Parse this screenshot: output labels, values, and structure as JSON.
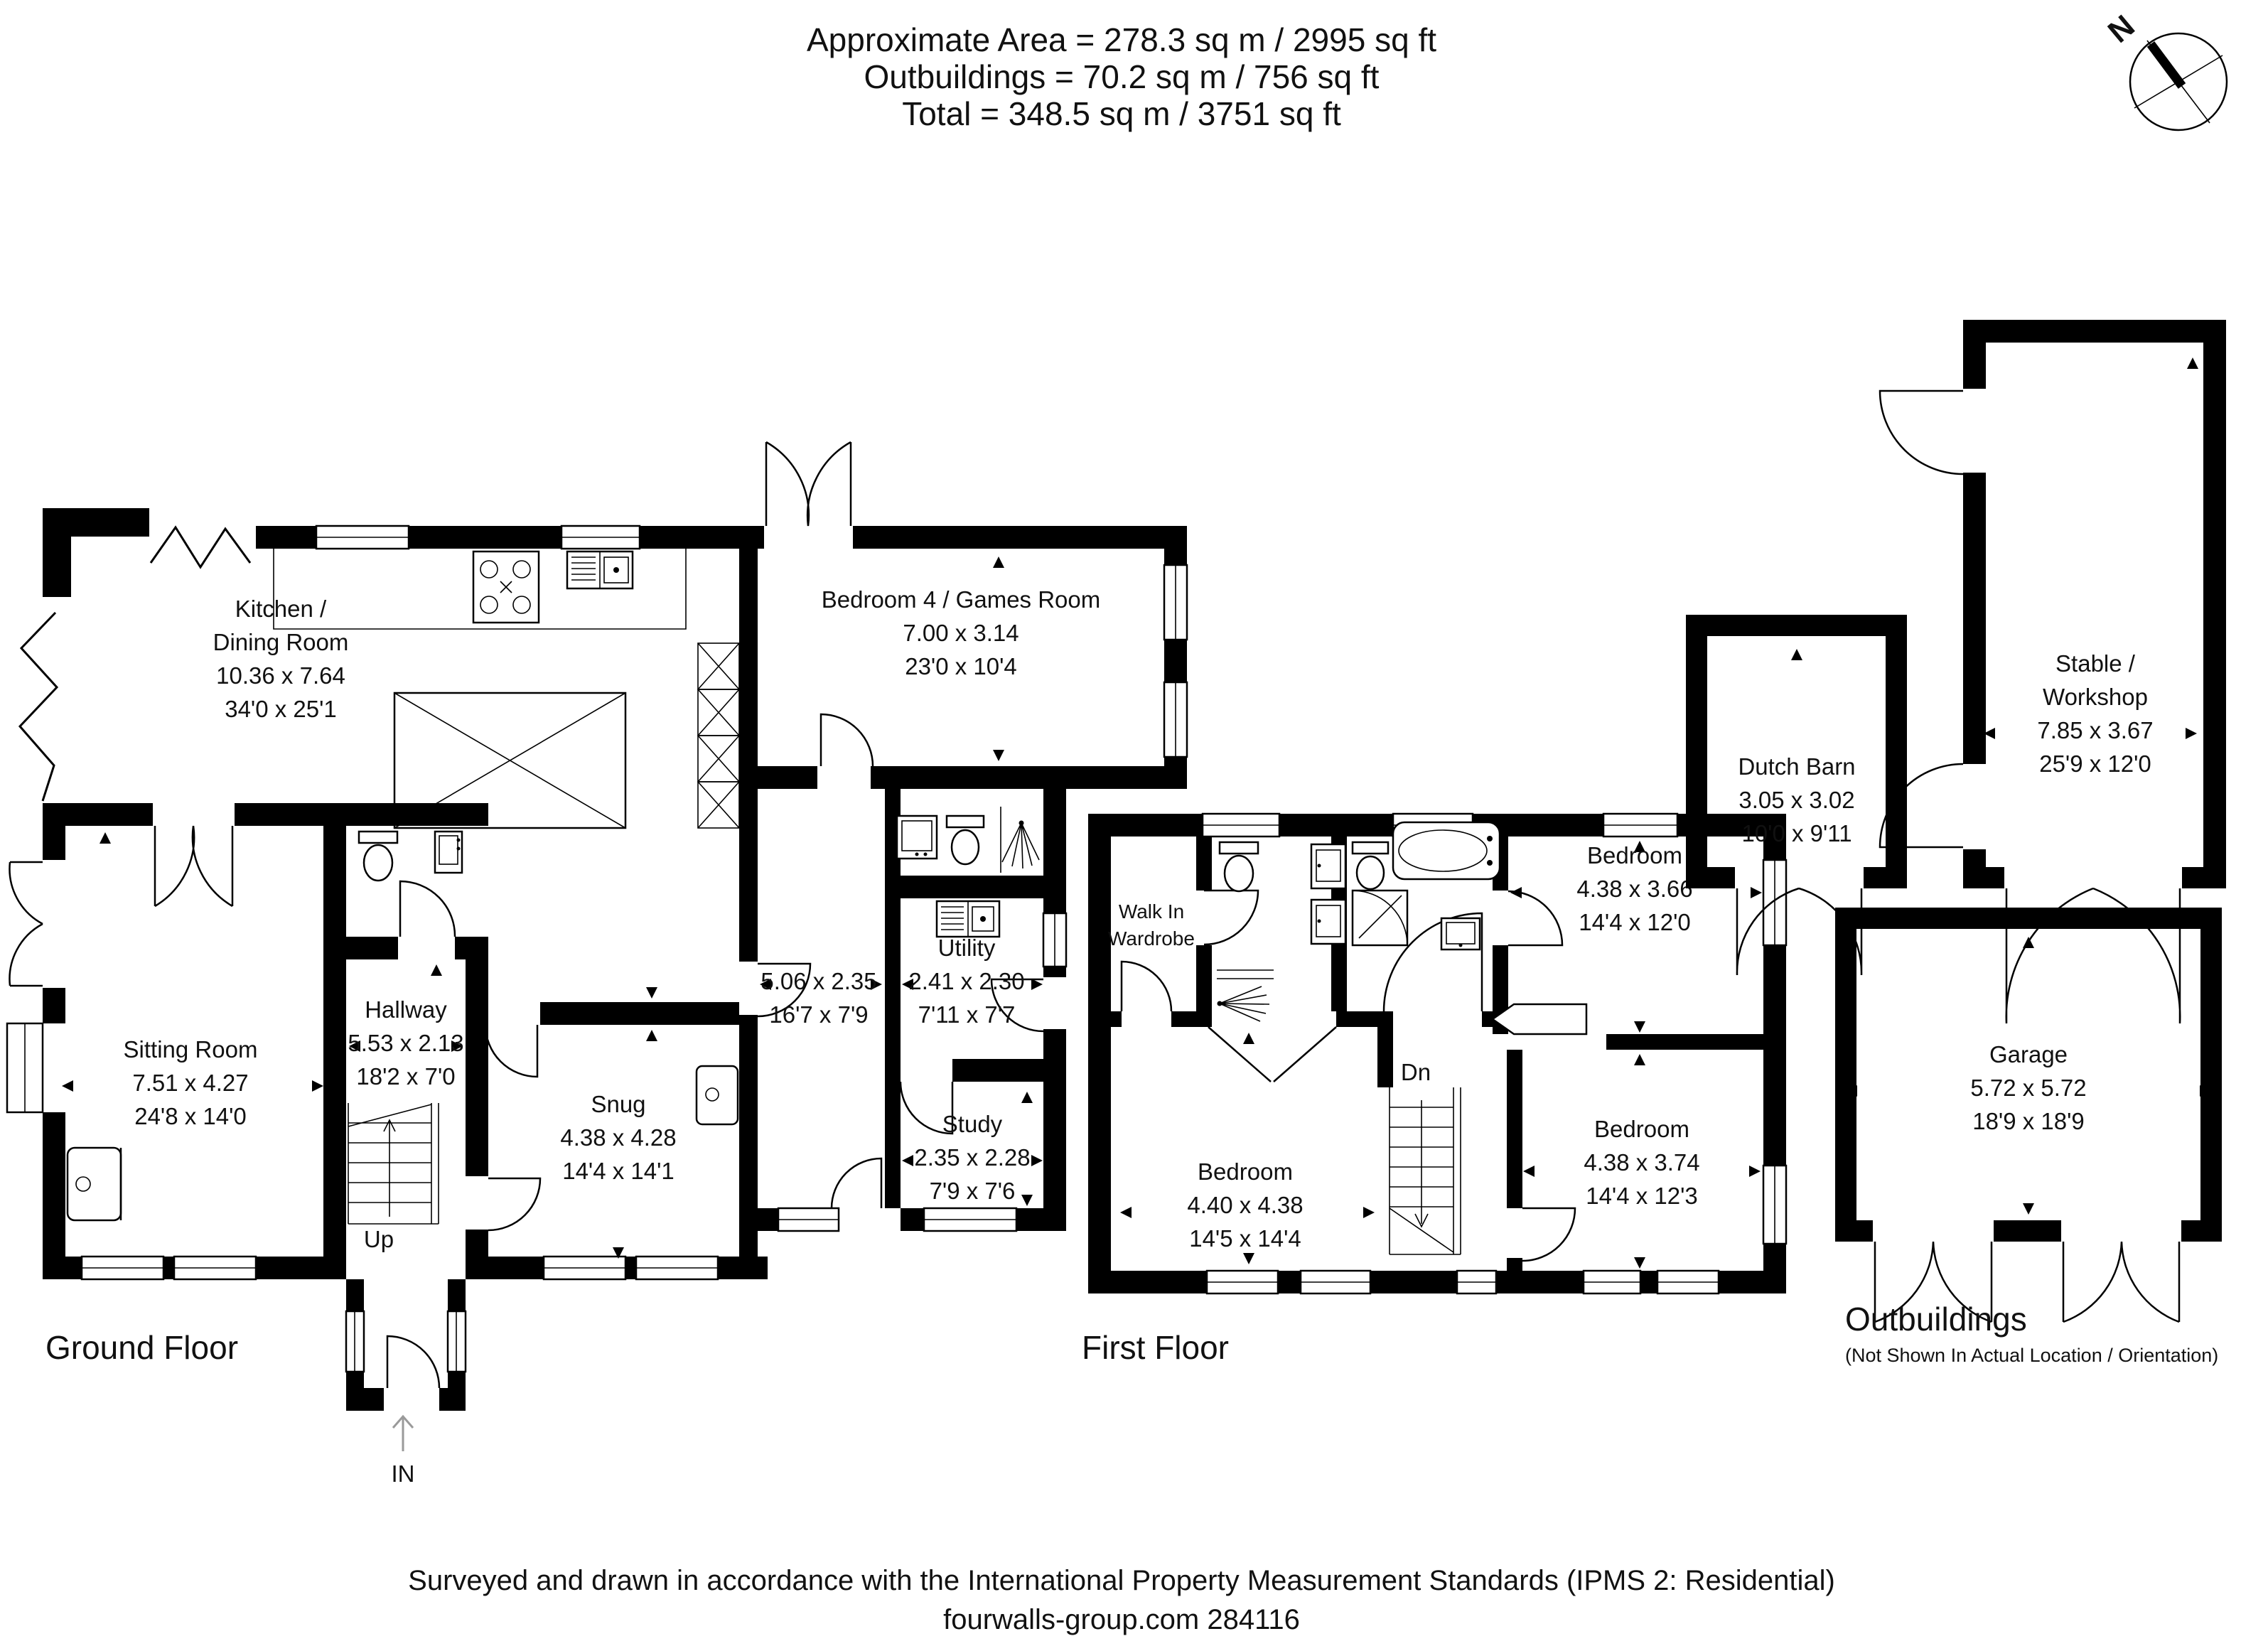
{
  "header": {
    "area_line": "Approximate  Area = 278.3 sq m / 2995 sq ft",
    "outbuildings_line": "Outbuildings = 70.2 sq m / 756 sq ft",
    "total_line": "Total = 348.5 sq m / 3751 sq ft"
  },
  "compass": {
    "north": "N"
  },
  "ground_floor": {
    "label": "Ground Floor",
    "stairs": "Up",
    "entrance": "IN",
    "rooms": {
      "kitchen": {
        "name_line1": "Kitchen /",
        "name_line2": "Dining Room",
        "metric": "10.36 x 7.64",
        "imperial": "34'0 x 25'1"
      },
      "bedroom4": {
        "name": "Bedroom 4 / Games Room",
        "metric": "7.00 x 3.14",
        "imperial": "23'0 x 10'4"
      },
      "sitting_room": {
        "name": "Sitting Room",
        "metric": "7.51 x 4.27",
        "imperial": "24'8 x 14'0"
      },
      "hallway": {
        "name": "Hallway",
        "metric": "5.53 x 2.13",
        "imperial": "18'2 x 7'0"
      },
      "snug": {
        "name": "Snug",
        "metric": "4.38 x 4.28",
        "imperial": "14'4 x 14'1"
      },
      "inner_hall": {
        "metric": "5.06 x 2.35",
        "imperial": "16'7 x 7'9"
      },
      "utility": {
        "name": "Utility",
        "metric": "2.41 x 2.30",
        "imperial": "7'11 x 7'7"
      },
      "study": {
        "name": "Study",
        "metric": "2.35 x 2.28",
        "imperial": "7'9 x 7'6"
      }
    }
  },
  "first_floor": {
    "label": "First Floor",
    "stairs": "Dn",
    "rooms": {
      "walk_in_wardrobe": {
        "name_line1": "Walk In",
        "name_line2": "Wardrobe"
      },
      "bedroom1": {
        "name": "Bedroom",
        "metric": "4.40 x 4.38",
        "imperial": "14'5 x 14'4"
      },
      "bedroom2": {
        "name": "Bedroom",
        "metric": "4.38 x 3.66",
        "imperial": "14'4 x 12'0"
      },
      "bedroom3": {
        "name": "Bedroom",
        "metric": "4.38 x 3.74",
        "imperial": "14'4 x 12'3"
      }
    }
  },
  "outbuildings": {
    "label": "Outbuildings",
    "note": "(Not Shown In Actual Location / Orientation)",
    "rooms": {
      "dutch_barn": {
        "name": "Dutch Barn",
        "metric": "3.05 x 3.02",
        "imperial": "10'0 x 9'11"
      },
      "stable": {
        "name_line1": "Stable /",
        "name_line2": "Workshop",
        "metric": "7.85 x 3.67",
        "imperial": "25'9 x 12'0"
      },
      "garage": {
        "name": "Garage",
        "metric": "5.72 x 5.72",
        "imperial": "18'9 x 18'9"
      }
    }
  },
  "footer": {
    "line1": "Surveyed and drawn in accordance with the International Property Measurement Standards (IPMS 2: Residential)",
    "line2": "fourwalls-group.com 284116"
  }
}
